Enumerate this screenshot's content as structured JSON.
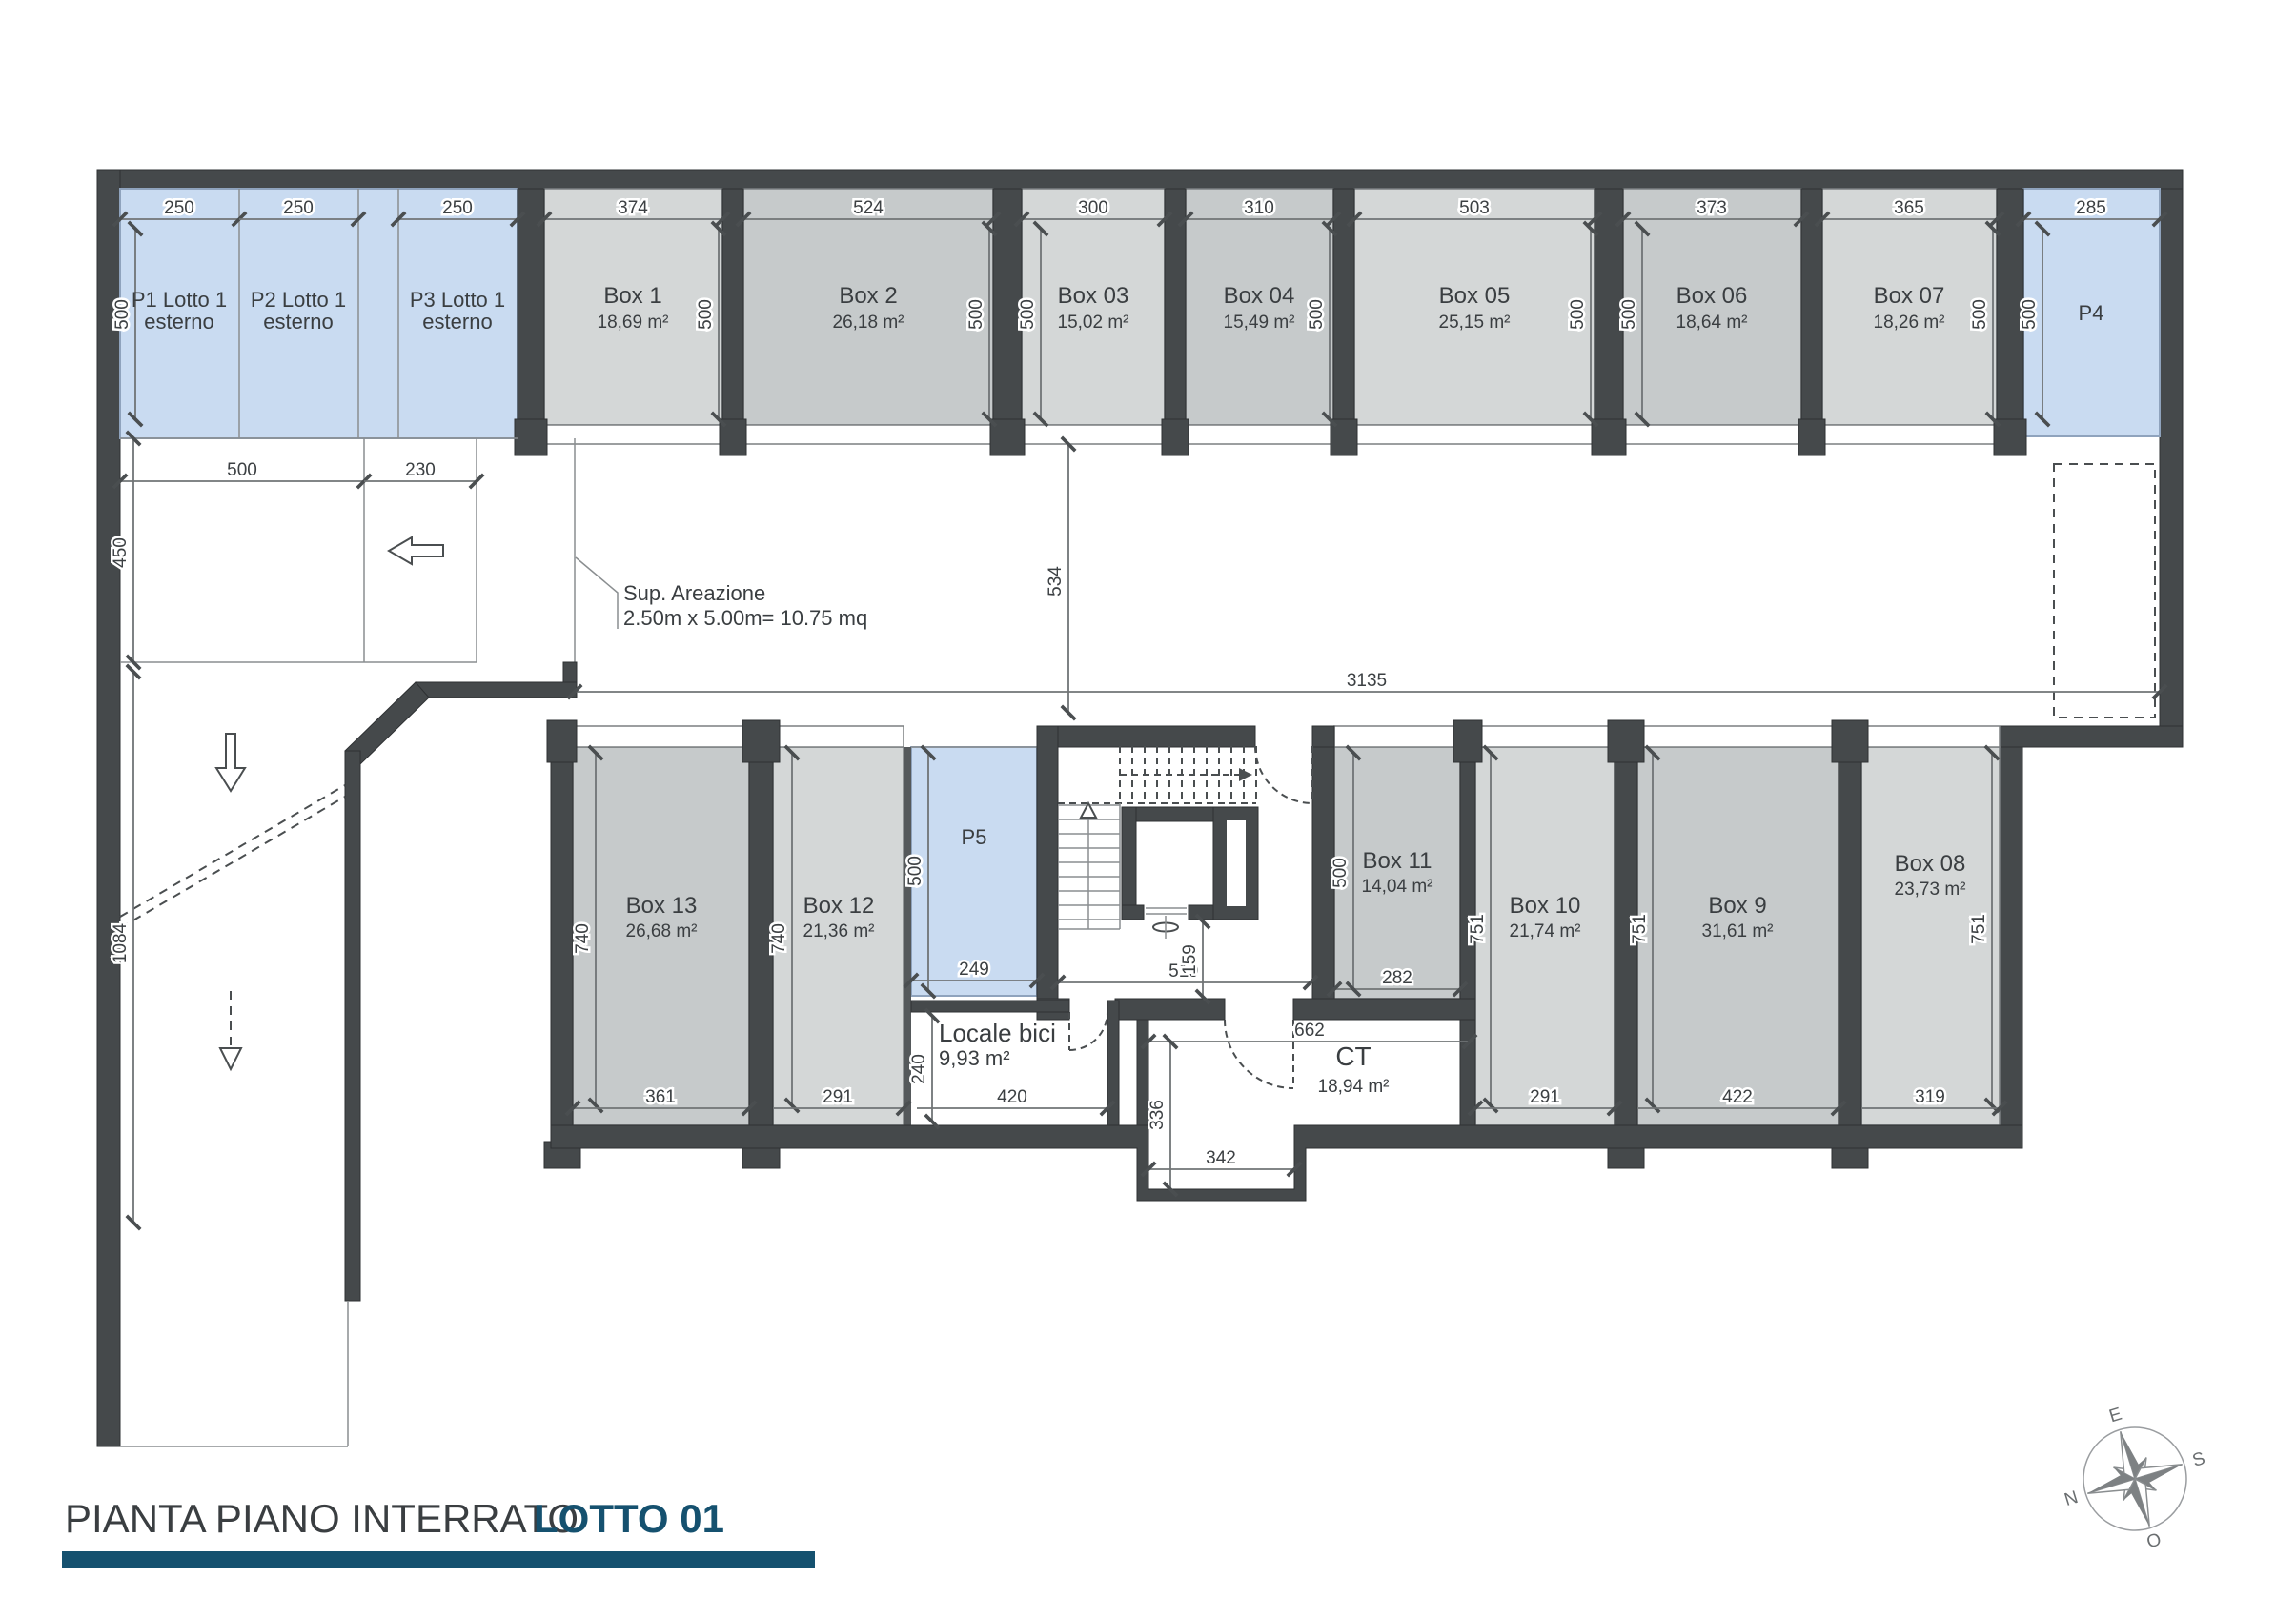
{
  "title": {
    "plan": "PIANTA PIANO INTERRATO",
    "lot": "LOTTO 01"
  },
  "annotation": {
    "sup1": "Sup. Areazione",
    "sup2": "2.50m x 5.00m= 10.75 mq"
  },
  "compass": {
    "n": "N",
    "e": "E",
    "s": "S",
    "o": "O"
  },
  "colors": {
    "wall": "#45494b",
    "box_dark": "#c6cacb",
    "box_light": "#d4d7d7",
    "parking_blue": "#c9dbf1",
    "accent": "#15516f"
  },
  "parking": {
    "p1a": "P1 Lotto 1",
    "p1b": "esterno",
    "p2a": "P2 Lotto 1",
    "p2b": "esterno",
    "p3a": "P3 Lotto 1",
    "p3b": "esterno",
    "p4": "P4",
    "p5": "P5"
  },
  "rooms": {
    "locale_name": "Locale bici",
    "locale_area": "9,93 m²",
    "ct_name": "CT",
    "ct_area": "18,94 m²"
  },
  "boxes": {
    "b1": {
      "name": "Box 1",
      "area": "18,69 m²"
    },
    "b2": {
      "name": "Box 2",
      "area": "26,18 m²"
    },
    "b3": {
      "name": "Box 03",
      "area": "15,02 m²"
    },
    "b4": {
      "name": "Box 04",
      "area": "15,49 m²"
    },
    "b5": {
      "name": "Box 05",
      "area": "25,15 m²"
    },
    "b6": {
      "name": "Box 06",
      "area": "18,64 m²"
    },
    "b7": {
      "name": "Box 07",
      "area": "18,26 m²"
    },
    "b8": {
      "name": "Box 08",
      "area": "23,73 m²"
    },
    "b9": {
      "name": "Box 9",
      "area": "31,61 m²"
    },
    "b10": {
      "name": "Box 10",
      "area": "21,74 m²"
    },
    "b11": {
      "name": "Box 11",
      "area": "14,04 m²"
    },
    "b12": {
      "name": "Box 12",
      "area": "21,36 m²"
    },
    "b13": {
      "name": "Box 13",
      "area": "26,68 m²"
    }
  },
  "dims": {
    "top": [
      "250",
      "250",
      "250",
      "374",
      "524",
      "300",
      "310",
      "503",
      "373",
      "365",
      "285"
    ],
    "v500": "500",
    "d230": "230",
    "d450": "450",
    "d1084": "1084",
    "d3135": "3135",
    "d534": "534",
    "d740": "740",
    "d361": "361",
    "d291": "291",
    "d249": "249",
    "d240": "240",
    "d420": "420",
    "d519": "519",
    "d159": "159",
    "d282": "282",
    "d751": "751",
    "d422": "422",
    "d319": "319",
    "d662": "662",
    "d336": "336",
    "d342": "342"
  }
}
